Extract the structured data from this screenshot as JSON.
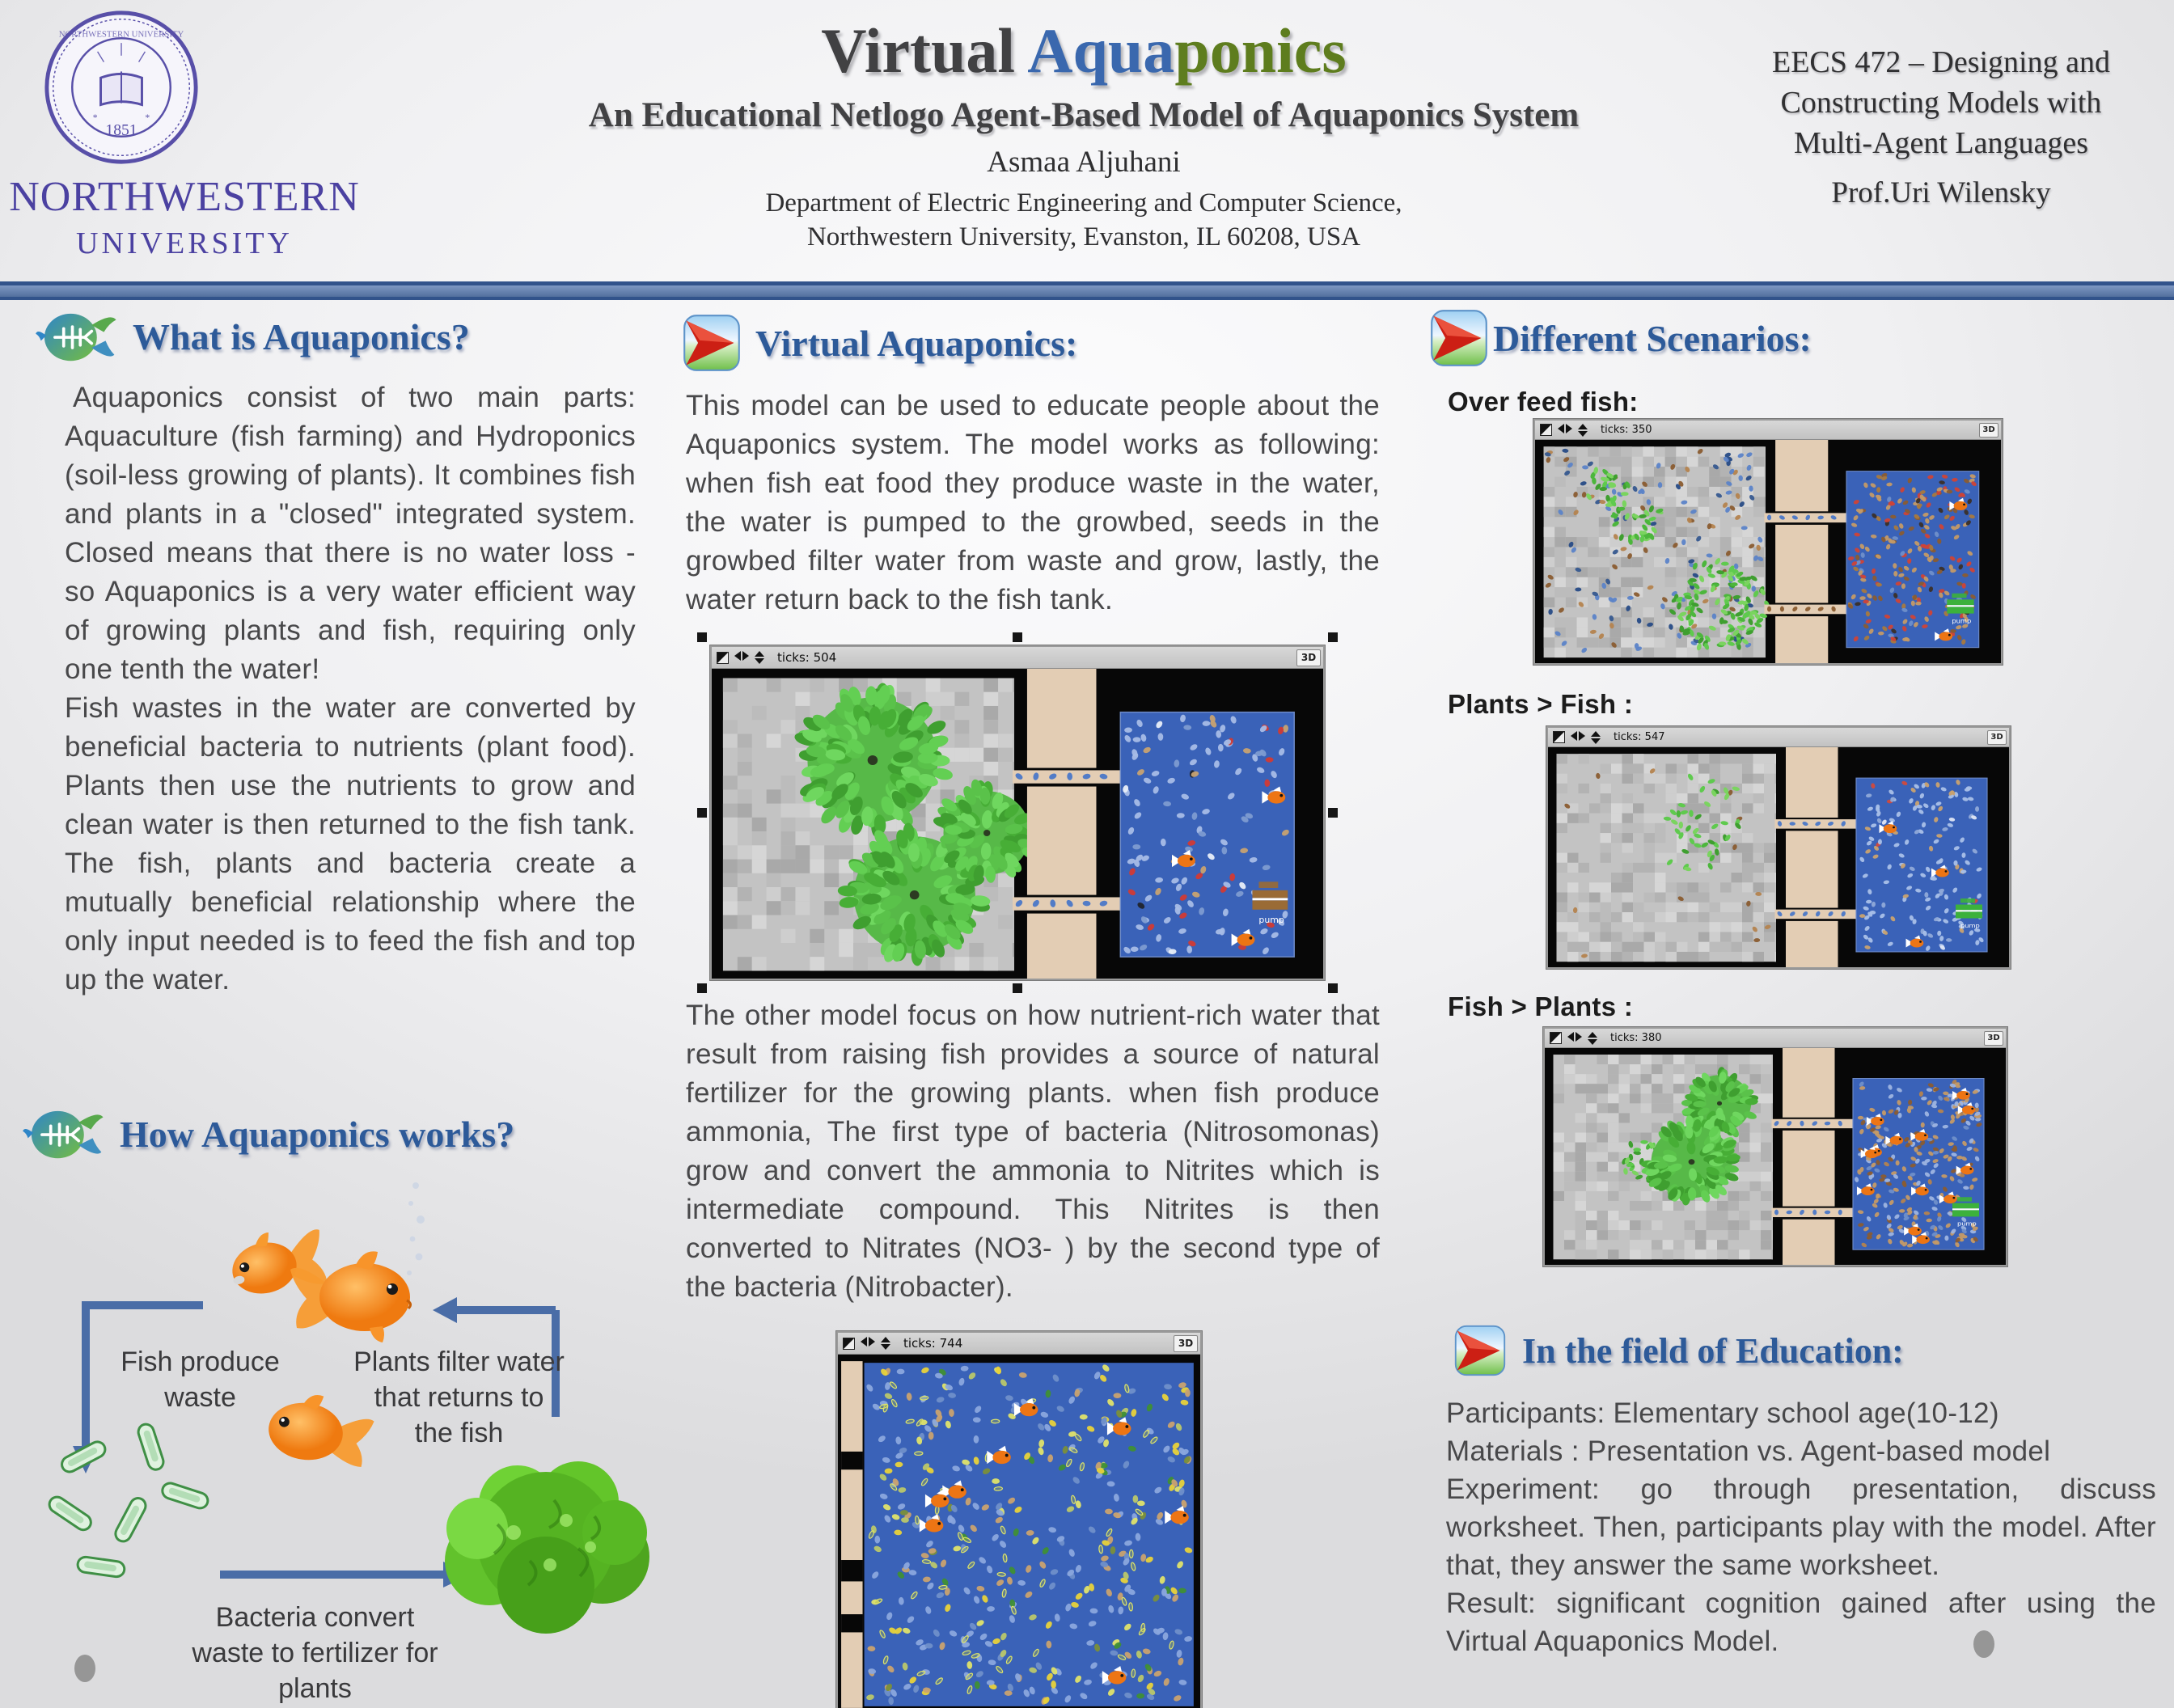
{
  "colors": {
    "title_dark": "#414143",
    "title_blue": "#3a68ae",
    "title_green": "#5e7d1e",
    "heading_blue": "#2d5a99",
    "divider_blue": "#53709e",
    "nu_purple": "#4b41a1"
  },
  "header": {
    "logo_line1": "NORTHWESTERN",
    "logo_line2": "UNIVERSITY",
    "seal_year": "1851",
    "title_part1": "Virtual ",
    "title_part2": "Aqua",
    "title_part3": "ponics",
    "subtitle": "An Educational Netlogo Agent-Based Model of Aquaponics System",
    "author": "Asmaa Aljuhani",
    "dept_line1": "Department of Electric Engineering and Computer Science,",
    "dept_line2": "Northwestern University, Evanston, IL 60208, USA",
    "course_line1": "EECS 472 – Designing and",
    "course_line2": "Constructing Models with",
    "course_line3": "Multi-Agent Languages",
    "professor": "Prof.Uri Wilensky"
  },
  "left": {
    "heading_what": "What is Aquaponics?",
    "what_para1": "Aquaponics consist of two main parts: Aquaculture (fish farming) and Hydroponics (soil-less growing of plants). It combines fish and plants in a \"closed\" integrated system. Closed means that there is no water loss - so Aquaponics is a very water efficient way of growing plants and fish, requiring only one tenth the water!",
    "what_para2": "Fish wastes in the water are converted by beneficial bacteria to nutrients (plant food). Plants then use the nutrients to grow and clean water is then returned to the fish tank. The fish, plants and bacteria create a mutually beneficial relationship where the only input needed is to feed the fish and top up the water.",
    "heading_how": "How Aquaponics works?",
    "label_fish_produce_waste": "Fish produce waste",
    "label_plants_filter": "Plants filter water that returns to the fish",
    "label_bacteria_convert": "Bacteria convert waste to fertilizer for plants"
  },
  "middle": {
    "heading": "Virtual Aquaponics:",
    "para1": "This model can be used to educate people about the Aquaponics system. The model works as following: when fish eat food they produce waste in the water, the water is pumped to the growbed, seeds in the growbed filter water from waste and grow, lastly, the water return back to the fish tank.",
    "model1_ticks": "ticks: 504",
    "para2": "The other model focus on how nutrient-rich water that result from raising fish provides a source of natural fertilizer for the growing plants. when fish produce ammonia, The first type of bacteria (Nitrosomonas) grow and convert the ammonia to Nitrites which is intermediate compound. This Nitrites is then converted to Nitrates  (NO3- ) by the second type of the bacteria (Nitrobacter).",
    "model2_ticks": "ticks: 744"
  },
  "right": {
    "heading_scenarios": "Different Scenarios:",
    "scenarios": [
      {
        "label": "Over feed fish:",
        "ticks": "ticks: 350"
      },
      {
        "label": "Plants > Fish :",
        "ticks": "ticks: 547"
      },
      {
        "label": "Fish > Plants :",
        "ticks": "ticks: 380"
      }
    ],
    "heading_education": "In the field of Education:",
    "education_lines": [
      "Participants: Elementary school age(10-12)",
      "Materials : Presentation vs. Agent-based model",
      "Experiment: go through presentation, discuss worksheet. Then,  participants play with the model. After that, they answer the same worksheet.",
      "Result: significant cognition gained after using the Virtual Aquaponics Model."
    ]
  },
  "netlogo": {
    "view_3d_button": "3D",
    "pump_label": "pump"
  }
}
